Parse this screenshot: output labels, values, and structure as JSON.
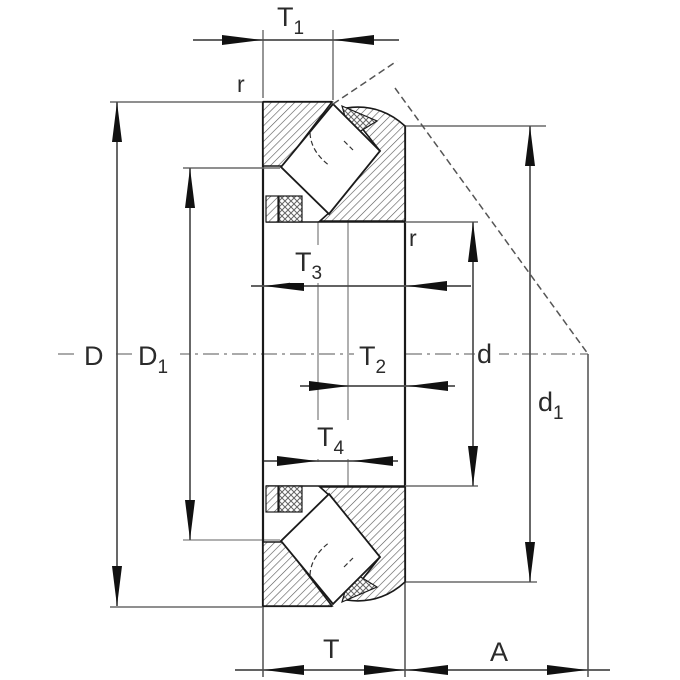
{
  "drawing": {
    "title": "spherical-roller-thrust-bearing-cross-section",
    "labels": {
      "t1": {
        "base": "T",
        "sub": "1"
      },
      "t2": {
        "base": "T",
        "sub": "2"
      },
      "t3": {
        "base": "T",
        "sub": "3"
      },
      "t4": {
        "base": "T",
        "sub": "4"
      },
      "T": {
        "base": "T",
        "sub": ""
      },
      "A": {
        "base": "A",
        "sub": ""
      },
      "D": {
        "base": "D",
        "sub": ""
      },
      "D1": {
        "base": "D",
        "sub": "1"
      },
      "d": {
        "base": "d",
        "sub": ""
      },
      "d1": {
        "base": "d",
        "sub": "1"
      },
      "r_top": {
        "base": "r",
        "sub": ""
      },
      "r_inner": {
        "base": "r",
        "sub": ""
      }
    },
    "colors": {
      "outline": "#1a1a1a",
      "dimension": "#4d4d4d",
      "extension_light": "#b0b0b0",
      "hatch": "#555555",
      "background": "#ffffff"
    }
  }
}
